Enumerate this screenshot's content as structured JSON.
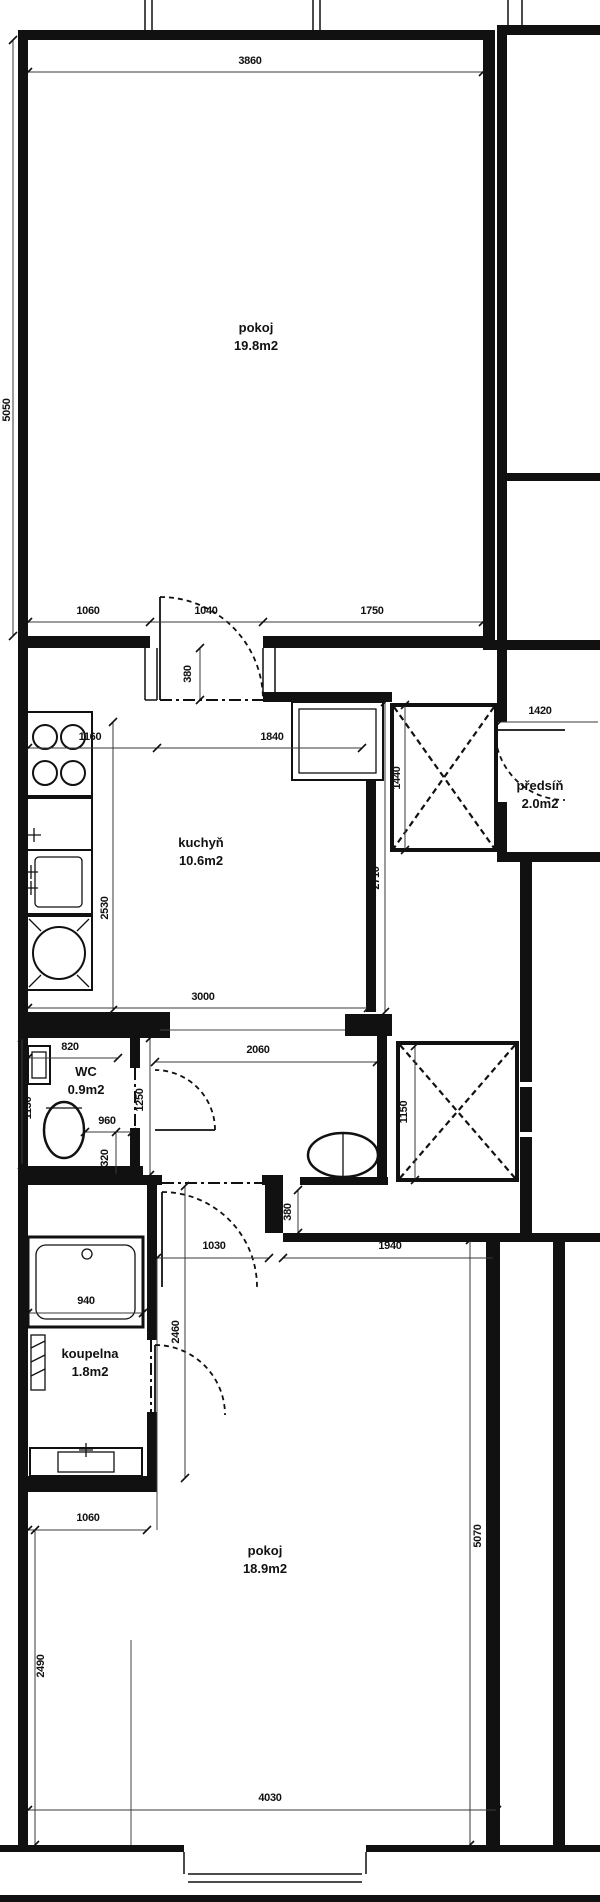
{
  "drawing": {
    "type": "apartment-floor-plan",
    "background_color": "#ffffff",
    "line_color": "#111111",
    "rooms": [
      {
        "id": "pokoj-1",
        "name": "pokoj",
        "area": "19.8m2",
        "x": 256,
        "y": 332
      },
      {
        "id": "kuchyn",
        "name": "kuchyň",
        "area": "10.6m2",
        "x": 201,
        "y": 847
      },
      {
        "id": "predsin",
        "name": "předsíň",
        "area": "2.0m2",
        "x": 540,
        "y": 790
      },
      {
        "id": "wc",
        "name": "WC",
        "area": "0.9m2",
        "x": 86,
        "y": 1076
      },
      {
        "id": "koupelna",
        "name": "koupelna",
        "area": "1.8m2",
        "x": 90,
        "y": 1358
      },
      {
        "id": "pokoj-2",
        "name": "pokoj",
        "area": "18.9m2",
        "x": 265,
        "y": 1555
      }
    ],
    "dimensions_mm": [
      {
        "label": "3860",
        "x": 250,
        "y": 64,
        "rotated": false
      },
      {
        "label": "5050",
        "x": 10,
        "y": 410,
        "rotated": true
      },
      {
        "label": "1060",
        "x": 88,
        "y": 614,
        "rotated": false
      },
      {
        "label": "1040",
        "x": 206,
        "y": 614,
        "rotated": false
      },
      {
        "label": "1750",
        "x": 372,
        "y": 614,
        "rotated": false
      },
      {
        "label": "380",
        "x": 191,
        "y": 674,
        "rotated": true
      },
      {
        "label": "1160",
        "x": 90,
        "y": 740,
        "rotated": false
      },
      {
        "label": "1840",
        "x": 272,
        "y": 740,
        "rotated": false
      },
      {
        "label": "1420",
        "x": 540,
        "y": 714,
        "rotated": false
      },
      {
        "label": "1440",
        "x": 400,
        "y": 778,
        "rotated": true
      },
      {
        "label": "2710",
        "x": 379,
        "y": 878,
        "rotated": true
      },
      {
        "label": "2530",
        "x": 108,
        "y": 908,
        "rotated": true
      },
      {
        "label": "3000",
        "x": 203,
        "y": 1000,
        "rotated": false
      },
      {
        "label": "820",
        "x": 70,
        "y": 1050,
        "rotated": false
      },
      {
        "label": "1130",
        "x": 31,
        "y": 1108,
        "rotated": true
      },
      {
        "label": "2060",
        "x": 258,
        "y": 1053,
        "rotated": false
      },
      {
        "label": "1250",
        "x": 143,
        "y": 1100,
        "rotated": true
      },
      {
        "label": "960",
        "x": 107,
        "y": 1124,
        "rotated": false
      },
      {
        "label": "320",
        "x": 108,
        "y": 1158,
        "rotated": true
      },
      {
        "label": "1150",
        "x": 407,
        "y": 1112,
        "rotated": true
      },
      {
        "label": "1030",
        "x": 214,
        "y": 1249,
        "rotated": false
      },
      {
        "label": "380",
        "x": 291,
        "y": 1212,
        "rotated": true
      },
      {
        "label": "1940",
        "x": 390,
        "y": 1249,
        "rotated": false
      },
      {
        "label": "940",
        "x": 86,
        "y": 1304,
        "rotated": false
      },
      {
        "label": "2460",
        "x": 179,
        "y": 1332,
        "rotated": true
      },
      {
        "label": "1060",
        "x": 88,
        "y": 1521,
        "rotated": false
      },
      {
        "label": "5070",
        "x": 481,
        "y": 1536,
        "rotated": true
      },
      {
        "label": "2490",
        "x": 44,
        "y": 1666,
        "rotated": true
      },
      {
        "label": "4030",
        "x": 270,
        "y": 1801,
        "rotated": false
      }
    ],
    "fixtures": [
      "stove-icon",
      "kitchen-counter-icon",
      "kitchen-sink-icon",
      "washing-machine-icon",
      "hand-basin-icon",
      "toilet-icon",
      "washbasin-icon",
      "bathtub-icon",
      "bathroom-sink-icon",
      "radiator-icon"
    ],
    "shaft_count": 2,
    "door_count": 5
  }
}
